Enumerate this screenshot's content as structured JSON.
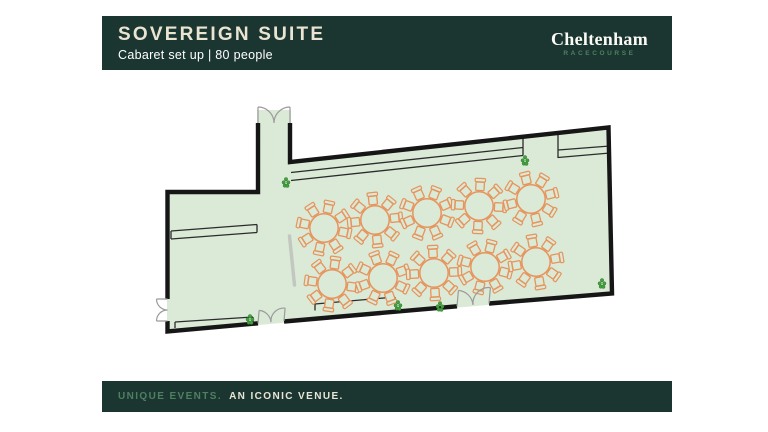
{
  "header": {
    "title": "SOVEREIGN SUITE",
    "subtitle": "Cabaret set up | 80 people",
    "logo": {
      "name": "Cheltenham",
      "tagline": "RACECOURSE"
    }
  },
  "footer": {
    "highlight": "UNIQUE EVENTS.",
    "rest": "AN ICONIC VENUE."
  },
  "colors": {
    "bar_background": "#1b3630",
    "title_cream": "#eae4d3",
    "accent_green": "#4f7f63",
    "floor_fill": "#dbe9d7",
    "wall": "#161616",
    "furniture_orange": "#e6945c",
    "plant_green": "#44a13e",
    "door_gray": "#9b9b9b",
    "screen_gray": "#c2c8c0"
  },
  "floor_plan": {
    "room": "Sovereign Suite",
    "setup": "Cabaret",
    "capacity_people": 80,
    "tables": {
      "count": 10,
      "chairs_per_table": 8,
      "shape": "round",
      "items": [
        [
          324,
          228,
          12
        ],
        [
          375,
          220,
          -6
        ],
        [
          427,
          213,
          21
        ],
        [
          479,
          206,
          3
        ],
        [
          531,
          199,
          -14
        ],
        [
          332,
          284,
          8
        ],
        [
          383,
          278,
          25
        ],
        [
          434,
          273,
          -3
        ],
        [
          485,
          267,
          15
        ],
        [
          536,
          262,
          -10
        ]
      ]
    },
    "plants": [
      [
        286,
        183
      ],
      [
        525,
        161
      ],
      [
        602,
        284
      ],
      [
        398,
        306
      ],
      [
        440,
        307
      ],
      [
        250,
        320
      ]
    ],
    "doors": {
      "count": 4,
      "type": "double"
    }
  }
}
